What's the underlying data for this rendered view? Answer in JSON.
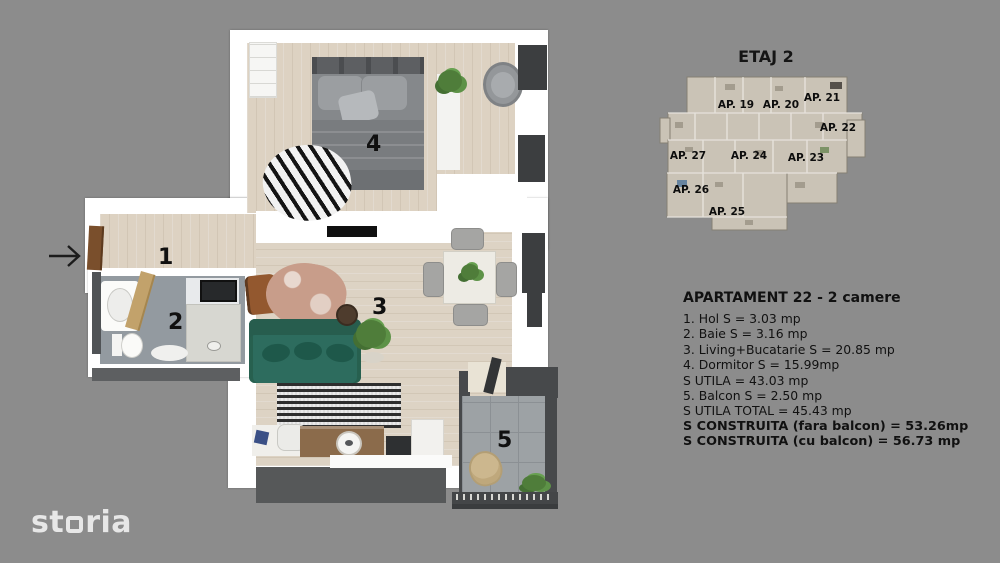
{
  "background": "#8c8c8c",
  "floorplan": {
    "room_labels": [
      "1",
      "2",
      "3",
      "4",
      "5"
    ]
  },
  "minimap": {
    "title": "ETAJ 2",
    "apartments": [
      {
        "label": "AP. 19"
      },
      {
        "label": "AP. 20"
      },
      {
        "label": "AP. 21"
      },
      {
        "label": "AP. 22"
      },
      {
        "label": "AP. 23"
      },
      {
        "label": "AP. 24"
      },
      {
        "label": "AP. 25"
      },
      {
        "label": "AP. 26"
      },
      {
        "label": "AP. 27"
      }
    ]
  },
  "details": {
    "title": "APARTAMENT 22 - 2 camere",
    "lines": [
      "1. Hol S = 3.03 mp",
      "2. Baie S = 3.16 mp",
      "3. Living+Bucatarie S = 20.85 mp",
      "4. Dormitor S = 15.99mp",
      "S UTILA = 43.03 mp",
      "5. Balcon S = 2.50 mp",
      "S UTILA TOTAL = 45.43 mp",
      "S CONSTRUITA (fara balcon) = 53.26mp",
      "S CONSTRUITA (cu balcon) = 56.73 mp"
    ]
  },
  "logo": {
    "prefix": "st",
    "suffix": "ria"
  },
  "colors": {
    "background": "#8c8c8c",
    "wall": "#ffffff",
    "wood_floor": "#ddd2c2",
    "bath_tile": "#939aa0",
    "balcony_tile": "#9da2a5",
    "sofa_green": "#2d6c5e",
    "dark_furniture": "#3c3e40",
    "text": "#111111",
    "logo": "#e7e7e7"
  }
}
